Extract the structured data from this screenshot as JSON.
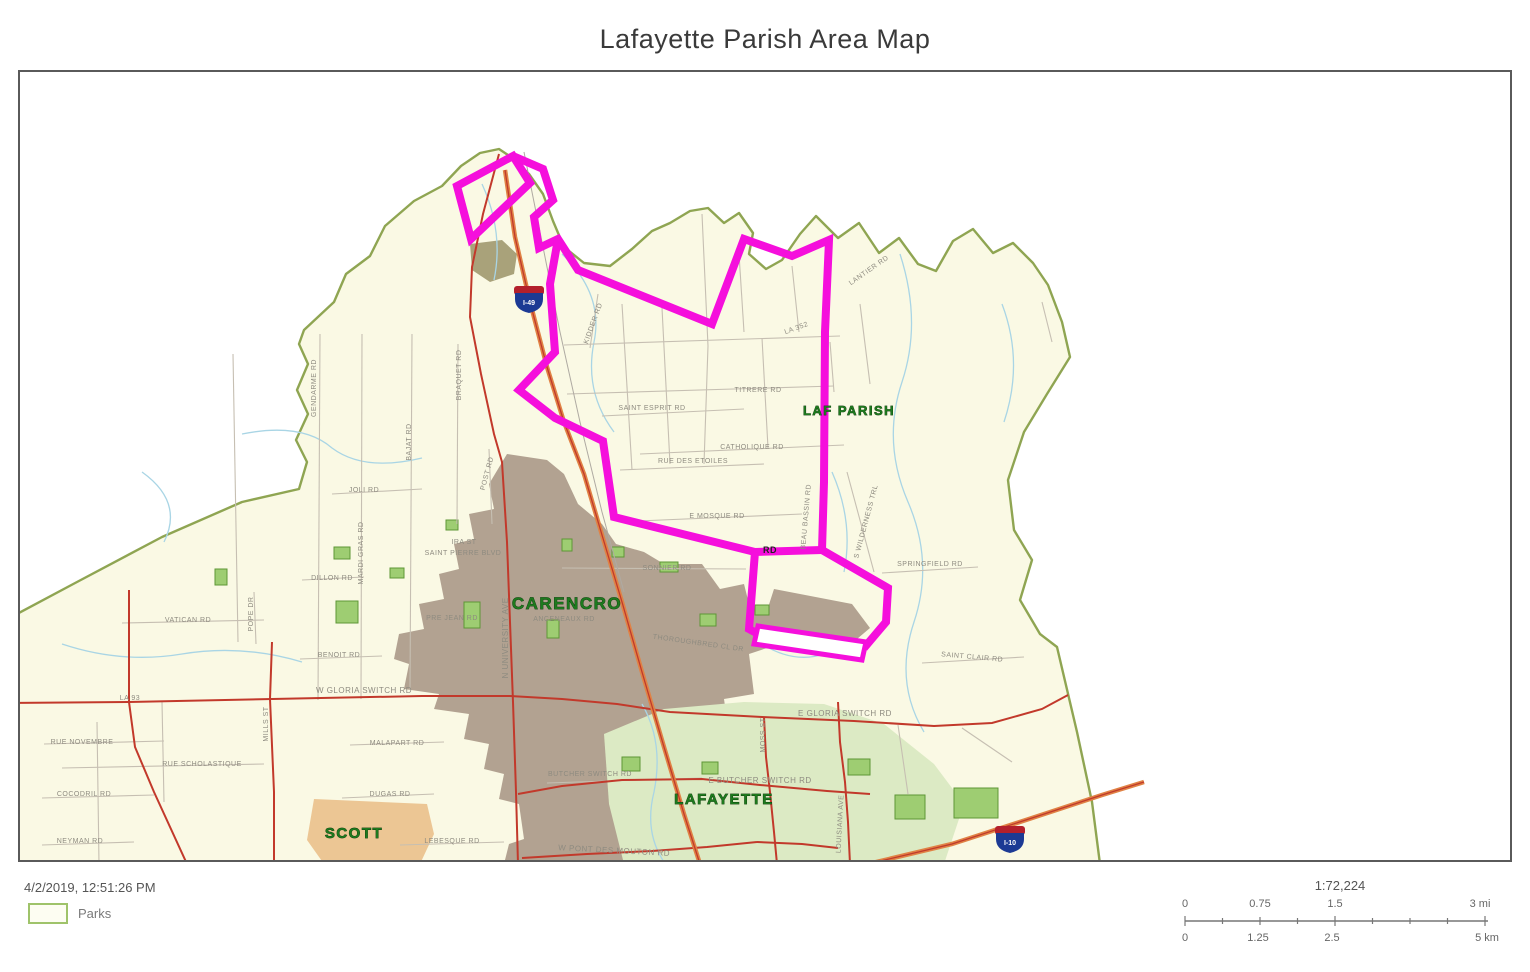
{
  "title": "Lafayette Parish Area Map",
  "footer": {
    "timestamp": "4/2/2019, 12:51:26 PM",
    "legend_label": "Parks"
  },
  "scalebar": {
    "ratio": "1:72,224",
    "mi_labels": [
      "0",
      "0.75",
      "1.5",
      "3 mi"
    ],
    "km_labels": [
      "0",
      "1.25",
      "2.5",
      "5 km"
    ]
  },
  "map": {
    "colors": {
      "parish_fill": "#FAF9E4",
      "boundary": "#8FA552",
      "stream": "#A9D5E5",
      "minor_road": "#C6BFB2",
      "major_road": "#C2392B",
      "highway": "#E08245",
      "highway_center": "#C0392B",
      "route": "#F50FDC",
      "park_fill": "#9ECD72",
      "park_border": "#5E9636",
      "road_label": "#8E8B80",
      "city_label": "#1E7A1E",
      "city_label_outline": "#072F07"
    },
    "parish": {
      "points": "0,620 75,580 160,535 240,500 297,487 305,460 294,438 306,412 295,388 306,362 297,342 302,328 332,300 344,272 368,254 383,224 412,199 440,184 459,164 478,151 497,147 512,157 527,172 541,192 551,219 562,245 582,261 608,264 630,247 650,229 668,221 688,209 706,206 722,221 737,211 751,231 747,252 764,267 780,258 798,232 814,214 836,236 857,221 877,251 897,236 916,262 934,269 951,239 971,227 991,251 1011,241 1031,261 1046,283 1060,320 1068,355 1045,392 1022,430 1006,478 1012,528 1030,558 1018,598 1038,632 1055,645 1075,730 1090,800 1098,862 0,862"
    },
    "areas": [
      {
        "name": "carencro-urban",
        "fill": "#B2A291",
        "points": "505,452 545,458 562,472 576,502 600,522 614,542 642,550 662,562 700,562 718,587 742,582 747,602 782,607 777,642 747,652 752,692 722,697 727,732 752,737 747,772 722,777 727,802 702,807 707,832 682,837 687,862 502,862 507,842 522,837 517,802 497,797 502,772 482,767 487,742 462,737 467,712 432,707 437,692 402,687 407,662 392,657 397,632 422,627 417,602 442,597 437,572 457,567 452,542 472,537 467,512 492,507 487,482"
      },
      {
        "name": "ne-industrial",
        "fill": "#B2A291",
        "points": "772,587 850,602 868,626 842,648 782,640 762,618"
      },
      {
        "name": "north-patch",
        "fill": "#A9A27A",
        "points": "468,242 500,238 515,252 512,272 488,280 470,268"
      },
      {
        "name": "scott-urban",
        "fill": "#ECC694",
        "points": "312,797 425,802 432,832 418,862 322,862 305,838"
      },
      {
        "name": "lafayette-green",
        "fill": "#DCEAC4",
        "points": "602,732 662,707 742,700 822,702 882,722 932,762 962,802 942,862 622,862 607,802"
      }
    ],
    "parks": [
      [
        334,
        599,
        22,
        22
      ],
      [
        462,
        600,
        16,
        26
      ],
      [
        213,
        567,
        12,
        16
      ],
      [
        545,
        618,
        12,
        18
      ],
      [
        658,
        560,
        18,
        10
      ],
      [
        698,
        612,
        16,
        12
      ],
      [
        753,
        603,
        14,
        10
      ],
      [
        332,
        545,
        16,
        12
      ],
      [
        388,
        566,
        14,
        10
      ],
      [
        444,
        518,
        12,
        10
      ],
      [
        952,
        786,
        44,
        30
      ],
      [
        893,
        793,
        30,
        24
      ],
      [
        846,
        757,
        22,
        16
      ],
      [
        620,
        755,
        18,
        14
      ],
      [
        700,
        760,
        16,
        12
      ],
      [
        560,
        537,
        10,
        12
      ],
      [
        610,
        545,
        12,
        10
      ]
    ],
    "streams": [
      "M240,432 Q300,420 330,446 Q362,470 420,456",
      "M60,642 Q120,662 180,652 Q240,642 300,660",
      "M480,182 Q502,230 492,278",
      "M560,252 Q602,292 592,340 Q582,390 612,430",
      "M898,252 Q920,320 900,380 Q880,440 906,500 Q932,560 912,620 Q892,680 922,730",
      "M1000,302 Q1022,360 1002,420",
      "M830,470 Q852,520 842,570",
      "M640,702 Q662,740 652,790 Q642,830 662,860",
      "M140,470 Q182,500 162,540",
      "M760,642 Q792,662 822,652"
    ],
    "minor_roads": [
      "M562,343 L838,334",
      "M565,392 L832,384",
      "M600,414 L742,407",
      "M638,452 L842,443",
      "M618,468 L762,462",
      "M636,519 L800,512",
      "M560,566 L744,567",
      "M620,302 L630,468",
      "M660,306 L668,462",
      "M700,212 L706,344 L702,462",
      "M737,252 L742,330",
      "M760,336 L766,446",
      "M790,264 L797,330",
      "M858,302 L868,382",
      "M596,292 L588,346",
      "M828,340 L832,390",
      "M231,352 L236,640",
      "M318,332 L316,698",
      "M360,332 L359,697",
      "M410,332 L408,688",
      "M456,342 L455,522",
      "M487,447 L490,522",
      "M252,590 L254,642",
      "M330,492 L420,487",
      "M300,578 L362,575",
      "M120,621 L262,618",
      "M298,657 L380,654",
      "M42,742 L162,739",
      "M60,766 L262,762",
      "M40,796 L152,793",
      "M40,843 L132,840",
      "M348,743 L442,740",
      "M340,796 L432,792",
      "M398,843 L502,840",
      "M95,720 L97,862",
      "M160,700 L162,800",
      "M545,781 L700,776",
      "M880,571 L976,565",
      "M920,661 L1022,655",
      "M845,470 L872,570",
      "M896,723 L906,792",
      "M960,726 L1010,760",
      "M1040,300 L1050,340"
    ],
    "major_roads": [
      "M0,701 L127,700 L270,697 L420,694 L508,694 L560,697 L615,702 L668,710 L760,715 L852,719 L932,724 L990,721 L1040,707 L1066,693",
      "M127,588 L127,700 L133,745 L152,790 L185,862",
      "M270,640 L268,697 L272,790 L272,862",
      "M497,152 L481,212 L470,265 L468,315 L479,372 L492,432 L500,460 L505,540 L508,620 L511,700 L514,790 L516,862",
      "M516,792 L560,784 L620,778 L700,777 L758,783 L825,789 L868,792",
      "M520,856 L585,852 L650,849 L705,845 L755,840",
      "M762,715 L764,755 L768,790 L772,830 L775,862",
      "M836,700 L838,740 L843,780 L846,820 L848,862",
      "M755,840 L800,842 L836,846"
    ],
    "highways": [
      "M503,168 L513,235 L528,300 L545,365 L562,420 L582,472 L600,533 L620,600 L640,670 L662,745 L682,812 L698,862",
      "M866,862 L950,842 L1030,816 L1100,793 L1142,780"
    ],
    "railroads": [
      "M522,150 L540,240 L558,330 L578,420 L600,510 L622,590"
    ],
    "route": {
      "width": 8,
      "paths": [
        "M511,154 L455,184 L469,237 L528,181 Z",
        "M511,154 L541,167 L551,198 L532,215 L537,246 L556,237 L576,268 L710,322 L742,237 L790,254 L827,238 L823,330 L822,480 L820,548",
        "M556,237 L548,282 L553,350 L517,388 L553,416 L601,439 L612,515 L753,550 L820,548",
        "M820,548 L886,586 L884,620 L862,646",
        "M753,550 L747,627 L758,633"
      ],
      "outlined_segment": "756,624 864,640 860,658 752,642"
    },
    "shields": [
      {
        "x": 527,
        "y": 297,
        "label": "I-49"
      },
      {
        "x": 1008,
        "y": 837,
        "label": "I-10"
      }
    ],
    "city_labels": [
      {
        "text": "CARENCRO",
        "x": 565,
        "y": 607,
        "size": 17
      },
      {
        "text": "SCOTT",
        "x": 352,
        "y": 836,
        "size": 15
      },
      {
        "text": "LAFAYETTE",
        "x": 722,
        "y": 802,
        "size": 15
      },
      {
        "text": "LAF PARISH",
        "x": 847,
        "y": 413,
        "size": 13
      }
    ],
    "road_labels": [
      {
        "text": "GENDARME RD",
        "x": 314,
        "y": 386,
        "size": 7,
        "rot": -90
      },
      {
        "text": "BRAQUET RD",
        "x": 459,
        "y": 373,
        "size": 7,
        "rot": -90
      },
      {
        "text": "BAJAT RD",
        "x": 409,
        "y": 440,
        "size": 7,
        "rot": -90
      },
      {
        "text": "JOLI RD",
        "x": 362,
        "y": 490,
        "size": 7,
        "rot": 0
      },
      {
        "text": "MARDI GRAS RD",
        "x": 361,
        "y": 551,
        "size": 7,
        "rot": -90
      },
      {
        "text": "POST RD",
        "x": 487,
        "y": 472,
        "size": 7,
        "rot": -75
      },
      {
        "text": "IRA ST",
        "x": 462,
        "y": 542,
        "size": 7,
        "rot": 0
      },
      {
        "text": "SAINT PIERRE BLVD",
        "x": 461,
        "y": 553,
        "size": 7,
        "rot": 0
      },
      {
        "text": "DILLON RD",
        "x": 330,
        "y": 578,
        "size": 7,
        "rot": 0
      },
      {
        "text": "VATICAN RD",
        "x": 186,
        "y": 620,
        "size": 7,
        "rot": 0
      },
      {
        "text": "POPE DR",
        "x": 251,
        "y": 612,
        "size": 7,
        "rot": -90
      },
      {
        "text": "BENOIT RD",
        "x": 337,
        "y": 655,
        "size": 7,
        "rot": 0
      },
      {
        "text": "W GLORIA SWITCH RD",
        "x": 362,
        "y": 691,
        "size": 8,
        "rot": 0
      },
      {
        "text": "MILLS ST",
        "x": 266,
        "y": 722,
        "size": 7,
        "rot": -90
      },
      {
        "text": "LA 93",
        "x": 128,
        "y": 698,
        "size": 7,
        "rot": 0
      },
      {
        "text": "RUE NOVEMBRE",
        "x": 80,
        "y": 742,
        "size": 7,
        "rot": 0
      },
      {
        "text": "RUE SCHOLASTIQUE",
        "x": 200,
        "y": 764,
        "size": 7,
        "rot": 0
      },
      {
        "text": "COCODRIL RD",
        "x": 82,
        "y": 794,
        "size": 7,
        "rot": 0
      },
      {
        "text": "NEYMAN RD",
        "x": 78,
        "y": 841,
        "size": 7,
        "rot": 0
      },
      {
        "text": "MALAPART RD",
        "x": 395,
        "y": 743,
        "size": 7,
        "rot": 0
      },
      {
        "text": "DUGAS RD",
        "x": 388,
        "y": 794,
        "size": 7,
        "rot": 0
      },
      {
        "text": "LEBESQUE RD",
        "x": 450,
        "y": 841,
        "size": 7,
        "rot": 0
      },
      {
        "text": "W PONT DES MOUTON RD",
        "x": 612,
        "y": 851,
        "size": 8,
        "rot": 3
      },
      {
        "text": "BUTCHER SWITCH RD",
        "x": 588,
        "y": 774,
        "size": 7,
        "rot": 0
      },
      {
        "text": "E BUTCHER SWITCH RD",
        "x": 758,
        "y": 781,
        "size": 8,
        "rot": 0
      },
      {
        "text": "E GLORIA SWITCH RD",
        "x": 843,
        "y": 714,
        "size": 8,
        "rot": 0
      },
      {
        "text": "MOSS ST",
        "x": 763,
        "y": 733,
        "size": 7,
        "rot": -90
      },
      {
        "text": "LOUISIANA AVE",
        "x": 840,
        "y": 822,
        "size": 7,
        "rot": -87
      },
      {
        "text": "N UNIVERSITY AVE",
        "x": 506,
        "y": 636,
        "size": 8,
        "rot": -90
      },
      {
        "text": "ANCENEAUX RD",
        "x": 562,
        "y": 619,
        "size": 7,
        "rot": 0
      },
      {
        "text": "SONNIER RD",
        "x": 665,
        "y": 568,
        "size": 7,
        "rot": 0
      },
      {
        "text": "THOROUGHBRED CL DR",
        "x": 696,
        "y": 643,
        "size": 7,
        "rot": 8
      },
      {
        "text": "PRE JEAN RD",
        "x": 450,
        "y": 618,
        "size": 7,
        "rot": 0
      },
      {
        "text": "SAINT ESPRIT RD",
        "x": 650,
        "y": 408,
        "size": 7,
        "rot": 0
      },
      {
        "text": "TITRERE RD",
        "x": 756,
        "y": 390,
        "size": 7,
        "rot": 0
      },
      {
        "text": "CATHOLIQUE RD",
        "x": 750,
        "y": 447,
        "size": 7,
        "rot": 0
      },
      {
        "text": "RUE DES ETOILES",
        "x": 691,
        "y": 461,
        "size": 7,
        "rot": 0
      },
      {
        "text": "E MOSQUE RD",
        "x": 715,
        "y": 516,
        "size": 7,
        "rot": 0
      },
      {
        "text": "KIDDER RD",
        "x": 593,
        "y": 322,
        "size": 7,
        "rot": -70
      },
      {
        "text": "LANTIER RD",
        "x": 868,
        "y": 270,
        "size": 7,
        "rot": -35
      },
      {
        "text": "LA 352",
        "x": 795,
        "y": 328,
        "size": 7,
        "rot": -20
      },
      {
        "text": "S WILDERNESS TRL",
        "x": 866,
        "y": 520,
        "size": 7,
        "rot": -75
      },
      {
        "text": "BEAU BASSIN RD",
        "x": 806,
        "y": 515,
        "size": 7,
        "rot": -85
      },
      {
        "text": "SPRINGFIELD RD",
        "x": 928,
        "y": 564,
        "size": 7,
        "rot": 0
      },
      {
        "text": "SAINT CLAIR RD",
        "x": 970,
        "y": 657,
        "size": 7,
        "rot": 5
      },
      {
        "text": "RD",
        "x": 768,
        "y": 551,
        "size": 9,
        "rot": 0,
        "bold": true
      }
    ]
  }
}
